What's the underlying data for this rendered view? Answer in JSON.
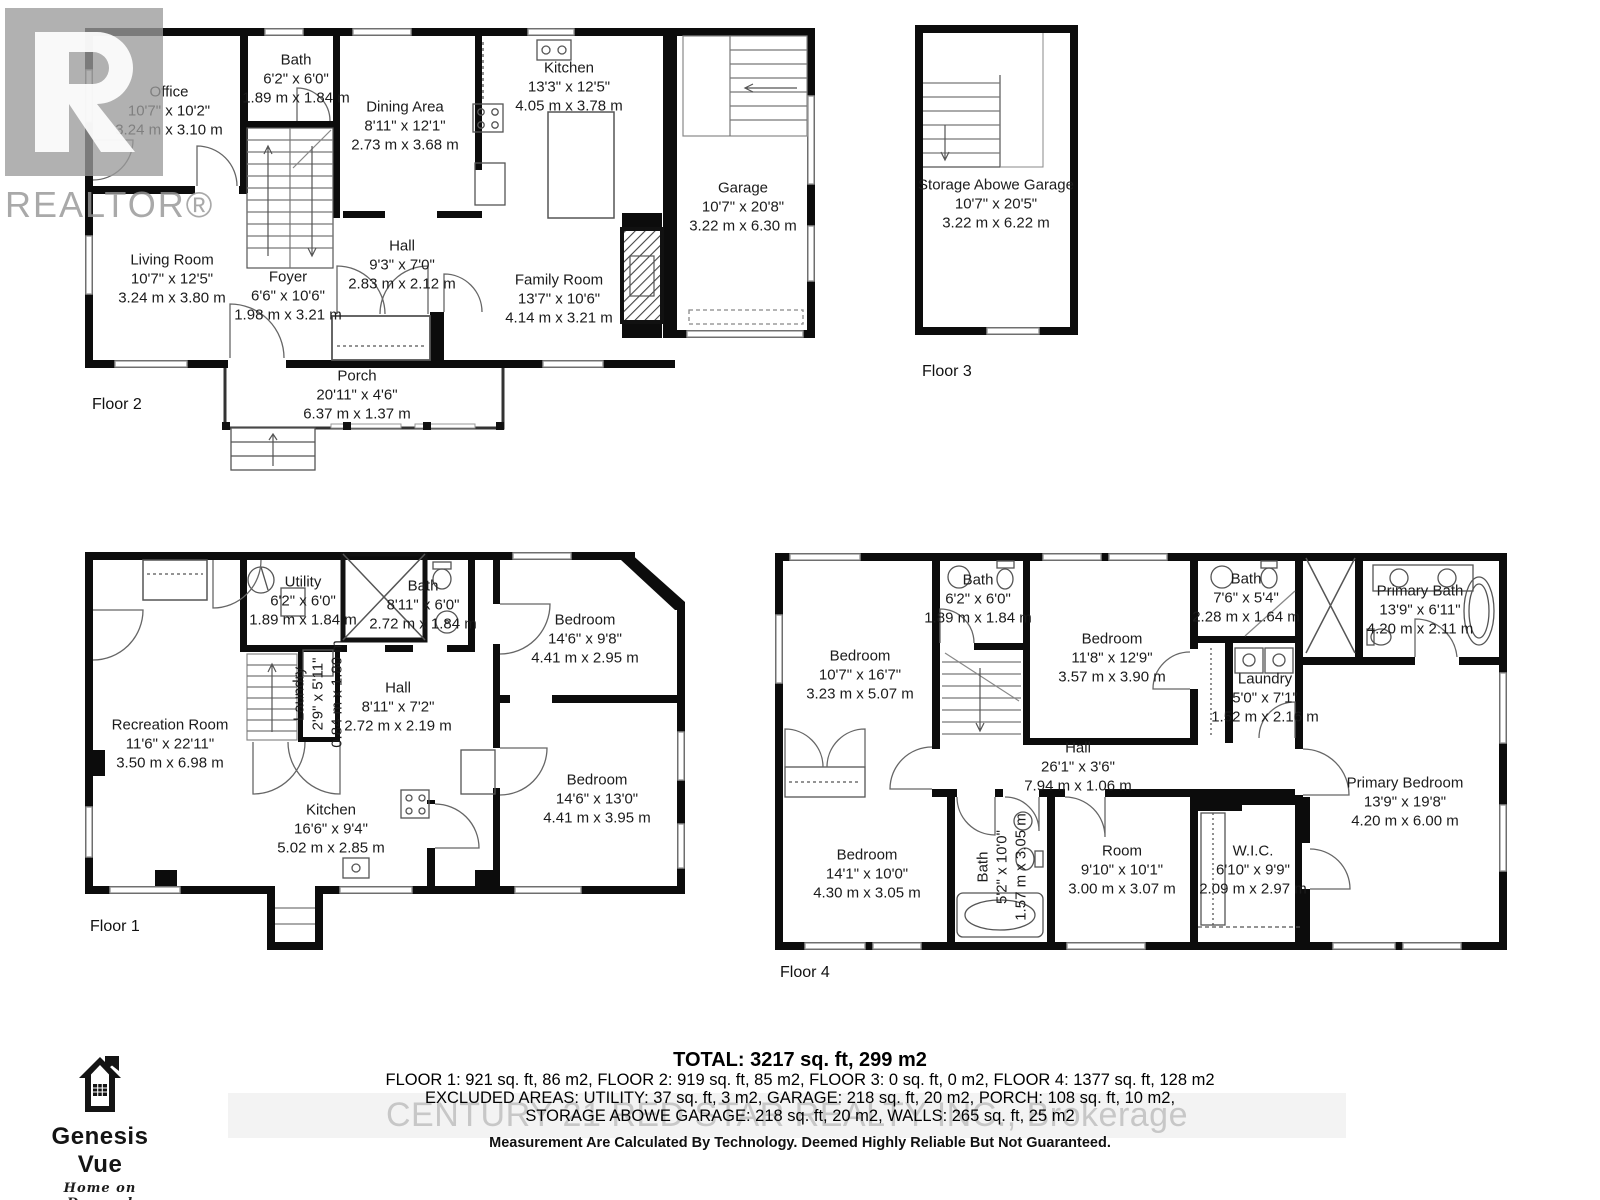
{
  "branding": {
    "realtor_text": "REALTOR®",
    "century21_watermark": "CENTURY 21 RED STAR REALTY INC., Brokerage",
    "genesis": {
      "name": "Genesis Vue",
      "tagline": "Home on Demand"
    }
  },
  "floors": [
    {
      "label": "Floor 2",
      "rooms": [
        {
          "name": "Office",
          "ft": "10'7\" x 10'2\"",
          "m": "3.24 m x 3.10 m"
        },
        {
          "name": "Bath",
          "ft": "6'2\" x 6'0\"",
          "m": "1.89 m x 1.84 m"
        },
        {
          "name": "Dining Area",
          "ft": "8'11\" x 12'1\"",
          "m": "2.73 m x 3.68 m"
        },
        {
          "name": "Kitchen",
          "ft": "13'3\" x 12'5\"",
          "m": "4.05 m x 3.78 m"
        },
        {
          "name": "Garage",
          "ft": "10'7\" x 20'8\"",
          "m": "3.22 m x 6.30 m"
        },
        {
          "name": "Living Room",
          "ft": "10'7\" x 12'5\"",
          "m": "3.24 m x 3.80 m"
        },
        {
          "name": "Foyer",
          "ft": "6'6\" x 10'6\"",
          "m": "1.98 m x 3.21 m"
        },
        {
          "name": "Hall",
          "ft": "9'3\" x 7'0\"",
          "m": "2.83 m x 2.12 m"
        },
        {
          "name": "Family Room",
          "ft": "13'7\" x 10'6\"",
          "m": "4.14 m x 3.21 m"
        },
        {
          "name": "Porch",
          "ft": "20'11\" x 4'6\"",
          "m": "6.37 m x 1.37 m"
        }
      ]
    },
    {
      "label": "Floor 3",
      "rooms": [
        {
          "name": "Storage Abowe Garage",
          "ft": "10'7\" x 20'5\"",
          "m": "3.22 m x 6.22 m"
        }
      ]
    },
    {
      "label": "Floor 1",
      "rooms": [
        {
          "name": "Utility",
          "ft": "6'2\" x 6'0\"",
          "m": "1.89 m x 1.84 m"
        },
        {
          "name": "Bath",
          "ft": "8'11\" x 6'0\"",
          "m": "2.72 m x 1.84 m"
        },
        {
          "name": "Bedroom",
          "ft": "14'6\" x 9'8\"",
          "m": "4.41 m x 2.95 m"
        },
        {
          "name": "Recreation Room",
          "ft": "11'6\" x 22'11\"",
          "m": "3.50 m x 6.98 m"
        },
        {
          "name": "Laundry",
          "ft": "2'9\" x 5'11\"",
          "m": "0.84 m x 1.80 m"
        },
        {
          "name": "Hall",
          "ft": "8'11\" x 7'2\"",
          "m": "2.72 m x 2.19 m"
        },
        {
          "name": "Kitchen",
          "ft": "16'6\" x 9'4\"",
          "m": "5.02 m x 2.85 m"
        },
        {
          "name": "Bedroom",
          "ft": "14'6\" x 13'0\"",
          "m": "4.41 m x 3.95 m"
        }
      ]
    },
    {
      "label": "Floor 4",
      "rooms": [
        {
          "name": "Bedroom",
          "ft": "10'7\" x 16'7\"",
          "m": "3.23 m x 5.07 m"
        },
        {
          "name": "Bath",
          "ft": "6'2\" x 6'0\"",
          "m": "1.89 m x 1.84 m"
        },
        {
          "name": "Bedroom",
          "ft": "11'8\" x 12'9\"",
          "m": "3.57 m x 3.90 m"
        },
        {
          "name": "Bath",
          "ft": "7'6\" x 5'4\"",
          "m": "2.28 m x 1.64 m"
        },
        {
          "name": "Primary Bath",
          "ft": "13'9\" x 6'11\"",
          "m": "4.20 m x 2.11 m"
        },
        {
          "name": "Laundry",
          "ft": "5'0\" x 7'1\"",
          "m": "1.52 m x 2.16 m"
        },
        {
          "name": "Hall",
          "ft": "26'1\" x 3'6\"",
          "m": "7.94 m x 1.06 m"
        },
        {
          "name": "Bedroom",
          "ft": "14'1\" x 10'0\"",
          "m": "4.30 m x 3.05 m"
        },
        {
          "name": "Bath",
          "ft": "5'2\" x 10'0\"",
          "m": "1.57 m x 3.05 m"
        },
        {
          "name": "Room",
          "ft": "9'10\" x 10'1\"",
          "m": "3.00 m x 3.07 m"
        },
        {
          "name": "W.I.C.",
          "ft": "6'10\" x 9'9\"",
          "m": "2.09 m x 2.97 m"
        },
        {
          "name": "Primary Bedroom",
          "ft": "13'9\" x 19'8\"",
          "m": "4.20 m x 6.00 m"
        }
      ]
    }
  ],
  "footer": {
    "total": "TOTAL: 3217 sq. ft, 299 m2",
    "floors_line": "FLOOR 1: 921 sq. ft, 86 m2, FLOOR 2: 919 sq. ft, 85 m2, FLOOR 3: 0 sq. ft, 0 m2, FLOOR 4: 1377 sq. ft, 128 m2",
    "excluded_line1": "EXCLUDED AREAS: UTILITY: 37 sq. ft, 3 m2, GARAGE: 218 sq. ft, 20 m2, PORCH: 108 sq. ft, 10 m2,",
    "excluded_line2": "STORAGE ABOWE GARAGE: 218 sq. ft, 20 m2, WALLS: 265 sq. ft, 25 m2",
    "disclaimer": "Measurement Are Calculated By Technology. Deemed Highly Reliable But Not Guaranteed."
  }
}
